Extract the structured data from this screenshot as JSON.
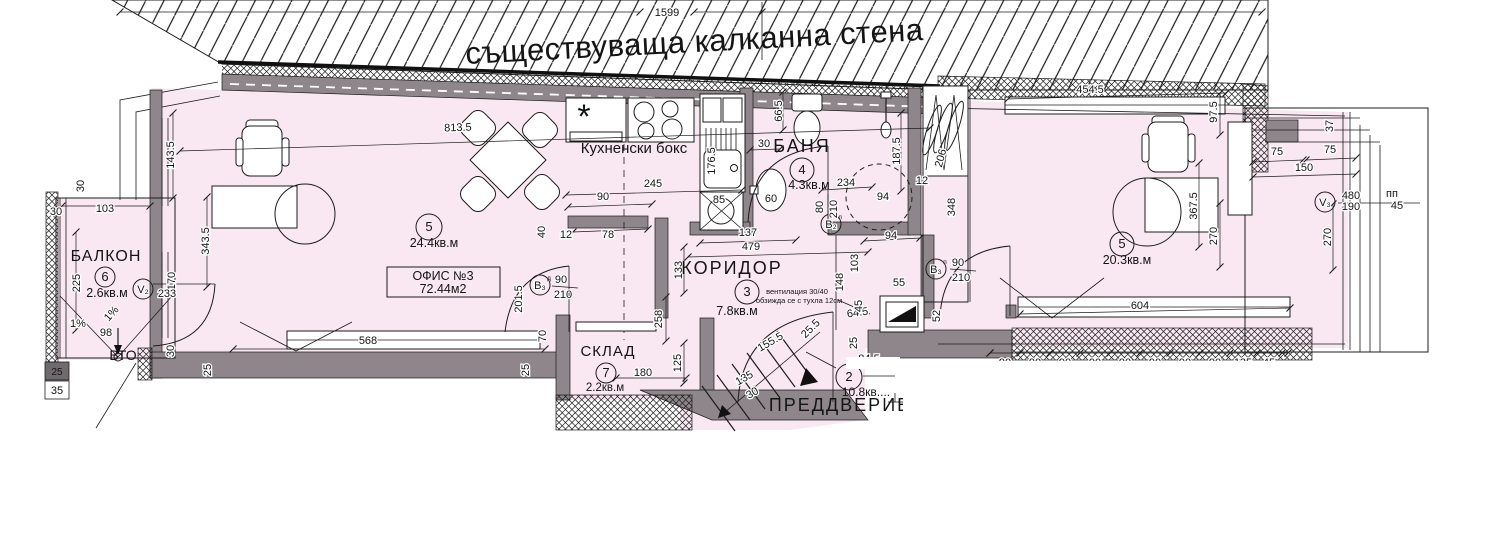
{
  "colors": {
    "floor": "#f9e8f1",
    "wall": "#8e868a",
    "wall_dark": "#6f6a6d",
    "line": "#1c1c1c",
    "bg": "#ffffff"
  },
  "top_wall": {
    "label": "съществуваща калканна стена"
  },
  "rooms": {
    "office": {
      "number": "5",
      "area": "24.4кв.м",
      "tag_line1": "ОФИС №3",
      "tag_line2": "72.44м2"
    },
    "kitchen": {
      "label": "Кухненски бокс",
      "star": "*"
    },
    "bath": {
      "label": "БАНЯ",
      "number": "4",
      "area": "4.3кв.м"
    },
    "corridor": {
      "label": "КОРИДОР",
      "number": "3",
      "area": "7.8кв.м",
      "note_line1": "вентилация 30/40",
      "note_line2": "обзижда се с тухла 12см"
    },
    "storage": {
      "label": "СКЛАД",
      "number": "7",
      "area": "2.2кв.м"
    },
    "balcony": {
      "label": "БАЛКОН",
      "number": "6",
      "area": "2.6кв.м",
      "vto_label": "ВТО",
      "block_dim": "25"
    },
    "vestibule": {
      "label": "ПРЕДДВЕРИЕ",
      "number": "2",
      "area": "10.8кв...."
    },
    "right_room": {
      "number": "5",
      "area": "20.3кв.м"
    }
  },
  "door_labels": {
    "office": {
      "code": "В₃",
      "variant": "д",
      "width": "90",
      "height": "210"
    },
    "bath": {
      "code": "В₂",
      "variant": "л",
      "width": "80",
      "height": "210"
    },
    "right": {
      "code": "В₃",
      "variant": "п",
      "width": "90",
      "height": "210"
    }
  },
  "window_labels": {
    "v2": {
      "code": "V₂"
    },
    "v3": {
      "code": "V₃"
    }
  },
  "dims": [
    {
      "v": "1599",
      "x": 667,
      "y": 16
    },
    {
      "v": "30",
      "x": 56,
      "y": 215
    },
    {
      "v": "103",
      "x": 105,
      "y": 212
    },
    {
      "v": "30",
      "x": 84,
      "y": 186,
      "r": -90
    },
    {
      "v": "225",
      "x": 80,
      "y": 283,
      "r": -90
    },
    {
      "v": "98",
      "x": 106,
      "y": 336
    },
    {
      "v": "1%",
      "x": 78,
      "y": 327,
      "fs": 10
    },
    {
      "v": "1%",
      "x": 114,
      "y": 316,
      "r": -48,
      "fs": 10
    },
    {
      "v": "35",
      "x": 57,
      "y": 394
    },
    {
      "v": "170",
      "x": 175,
      "y": 281,
      "r": -90
    },
    {
      "v": "233",
      "x": 167,
      "y": 297
    },
    {
      "v": "143.5",
      "x": 174,
      "y": 155,
      "r": -90
    },
    {
      "v": "343.5",
      "x": 209,
      "y": 241,
      "r": -90
    },
    {
      "v": "813.5",
      "x": 458,
      "y": 131,
      "r": -2
    },
    {
      "v": "568",
      "x": 368,
      "y": 344
    },
    {
      "v": "30",
      "x": 174,
      "y": 351,
      "r": -90
    },
    {
      "v": "25",
      "x": 211,
      "y": 370,
      "r": -90
    },
    {
      "v": "70",
      "x": 546,
      "y": 336,
      "r": -90
    },
    {
      "v": "25",
      "x": 529,
      "y": 370,
      "r": -90
    },
    {
      "v": "90",
      "x": 603,
      "y": 200
    },
    {
      "v": "78",
      "x": 608,
      "y": 238
    },
    {
      "v": "40",
      "x": 545,
      "y": 232,
      "r": -90
    },
    {
      "v": "12",
      "x": 566,
      "y": 238
    },
    {
      "v": "201.5",
      "x": 522,
      "y": 299,
      "r": -90
    },
    {
      "v": "245",
      "x": 653,
      "y": 187
    },
    {
      "v": "176.5",
      "x": 715,
      "y": 161,
      "r": -90
    },
    {
      "v": "66.5",
      "x": 782,
      "y": 111,
      "r": -90
    },
    {
      "v": "30",
      "x": 764,
      "y": 147
    },
    {
      "v": "85",
      "x": 719,
      "y": 203
    },
    {
      "v": "60",
      "x": 771,
      "y": 202
    },
    {
      "v": "234",
      "x": 846,
      "y": 186
    },
    {
      "v": "187.5",
      "x": 900,
      "y": 151,
      "r": -90
    },
    {
      "v": "94",
      "x": 883,
      "y": 200
    },
    {
      "v": "12",
      "x": 922,
      "y": 184
    },
    {
      "v": "94",
      "x": 891,
      "y": 239
    },
    {
      "v": "348",
      "x": 955,
      "y": 207,
      "r": -90
    },
    {
      "v": "206",
      "x": 944,
      "y": 159,
      "r": -75
    },
    {
      "v": "137",
      "x": 748,
      "y": 236
    },
    {
      "v": "479",
      "x": 751,
      "y": 250
    },
    {
      "v": "133",
      "x": 682,
      "y": 270,
      "r": -90
    },
    {
      "v": "258",
      "x": 662,
      "y": 319,
      "r": -90
    },
    {
      "v": "125",
      "x": 681,
      "y": 363,
      "r": -90
    },
    {
      "v": "148",
      "x": 843,
      "y": 282,
      "r": -90
    },
    {
      "v": "103",
      "x": 858,
      "y": 263,
      "r": -90
    },
    {
      "v": "55",
      "x": 899,
      "y": 286
    },
    {
      "v": "64.5",
      "x": 858,
      "y": 316,
      "r": -8
    },
    {
      "v": "45",
      "x": 862,
      "y": 306,
      "r": -90
    },
    {
      "v": "25",
      "x": 857,
      "y": 343,
      "r": -90
    },
    {
      "v": "52",
      "x": 940,
      "y": 316,
      "r": -90
    },
    {
      "v": "155.5",
      "x": 772,
      "y": 345,
      "r": -30,
      "fs": 13
    },
    {
      "v": "135",
      "x": 746,
      "y": 381,
      "r": -30
    },
    {
      "v": "30",
      "x": 754,
      "y": 396,
      "r": -30
    },
    {
      "v": "25.5",
      "x": 813,
      "y": 331,
      "r": -45
    },
    {
      "v": "180",
      "x": 643,
      "y": 376
    },
    {
      "v": "454.5",
      "x": 1090,
      "y": 93
    },
    {
      "v": "97.5",
      "x": 1217,
      "y": 112,
      "r": -90
    },
    {
      "v": "367.5",
      "x": 1197,
      "y": 206,
      "r": -90
    },
    {
      "v": "270",
      "x": 1217,
      "y": 236,
      "r": -90
    },
    {
      "v": "604",
      "x": 1140,
      "y": 309
    },
    {
      "v": "75",
      "x": 1277,
      "y": 155
    },
    {
      "v": "75",
      "x": 1330,
      "y": 153
    },
    {
      "v": "150",
      "x": 1304,
      "y": 171
    },
    {
      "v": "37",
      "x": 1333,
      "y": 126,
      "r": -90
    },
    {
      "v": "270",
      "x": 1331,
      "y": 237,
      "r": -90
    },
    {
      "v": "480",
      "x": 1351,
      "y": 199
    },
    {
      "v": "190",
      "x": 1351,
      "y": 210
    },
    {
      "v": "пп",
      "x": 1392,
      "y": 197,
      "fs": 10
    },
    {
      "v": "45",
      "x": 1397,
      "y": 209,
      "fs": 10
    }
  ],
  "clipped_dims": [
    {
      "v": "84.5",
      "x": 869,
      "y": 362
    },
    {
      "v": "90",
      "x": 1005,
      "y": 366
    },
    {
      "v": "90",
      "x": 1035,
      "y": 366
    },
    {
      "v": "90",
      "x": 1065,
      "y": 366
    },
    {
      "v": "90",
      "x": 1095,
      "y": 366
    },
    {
      "v": "90",
      "x": 1125,
      "y": 366
    },
    {
      "v": "90",
      "x": 1155,
      "y": 366
    },
    {
      "v": "90",
      "x": 1185,
      "y": 366
    },
    {
      "v": "90",
      "x": 1215,
      "y": 366
    },
    {
      "v": "135",
      "x": 1243,
      "y": 366
    },
    {
      "v": "45",
      "x": 1269,
      "y": 366
    }
  ],
  "dim_lines": [
    [
      120,
      12,
      640,
      12
    ],
    [
      694,
      12,
      1262,
      12
    ],
    [
      180,
      151,
      930,
      128
    ],
    [
      173,
      113,
      173,
      198
    ],
    [
      207,
      197,
      207,
      287
    ],
    [
      566,
      195,
      742,
      190
    ],
    [
      568,
      207,
      652,
      204
    ],
    [
      573,
      232,
      648,
      229
    ],
    [
      700,
      243,
      796,
      240
    ],
    [
      688,
      257,
      868,
      252
    ],
    [
      901,
      113,
      901,
      191
    ],
    [
      1008,
      99,
      1226,
      93
    ],
    [
      1020,
      314,
      1290,
      308
    ],
    [
      1199,
      163,
      1199,
      247
    ],
    [
      1220,
      93,
      1220,
      135
    ],
    [
      1220,
      203,
      1220,
      267
    ],
    [
      1333,
      204,
      1333,
      270
    ],
    [
      1253,
      162,
      1303,
      160
    ],
    [
      1306,
      160,
      1356,
      158
    ],
    [
      1253,
      177,
      1356,
      174
    ],
    [
      233,
      349,
      545,
      349
    ],
    [
      616,
      378,
      686,
      378
    ],
    [
      684,
      247,
      684,
      293
    ],
    [
      666,
      297,
      666,
      341
    ],
    [
      684,
      343,
      684,
      383
    ],
    [
      990,
      353,
      1288,
      353
    ],
    [
      62,
      206,
      150,
      206
    ],
    [
      76,
      232,
      76,
      330
    ],
    [
      864,
      241,
      920,
      238
    ],
    [
      822,
      190,
      872,
      187
    ],
    [
      783,
      92,
      783,
      130
    ],
    [
      750,
      150,
      780,
      149
    ]
  ],
  "tick_row": {
    "y": 353,
    "xs": [
      990,
      1020,
      1050,
      1080,
      1110,
      1140,
      1170,
      1200,
      1230,
      1257,
      1282
    ]
  }
}
